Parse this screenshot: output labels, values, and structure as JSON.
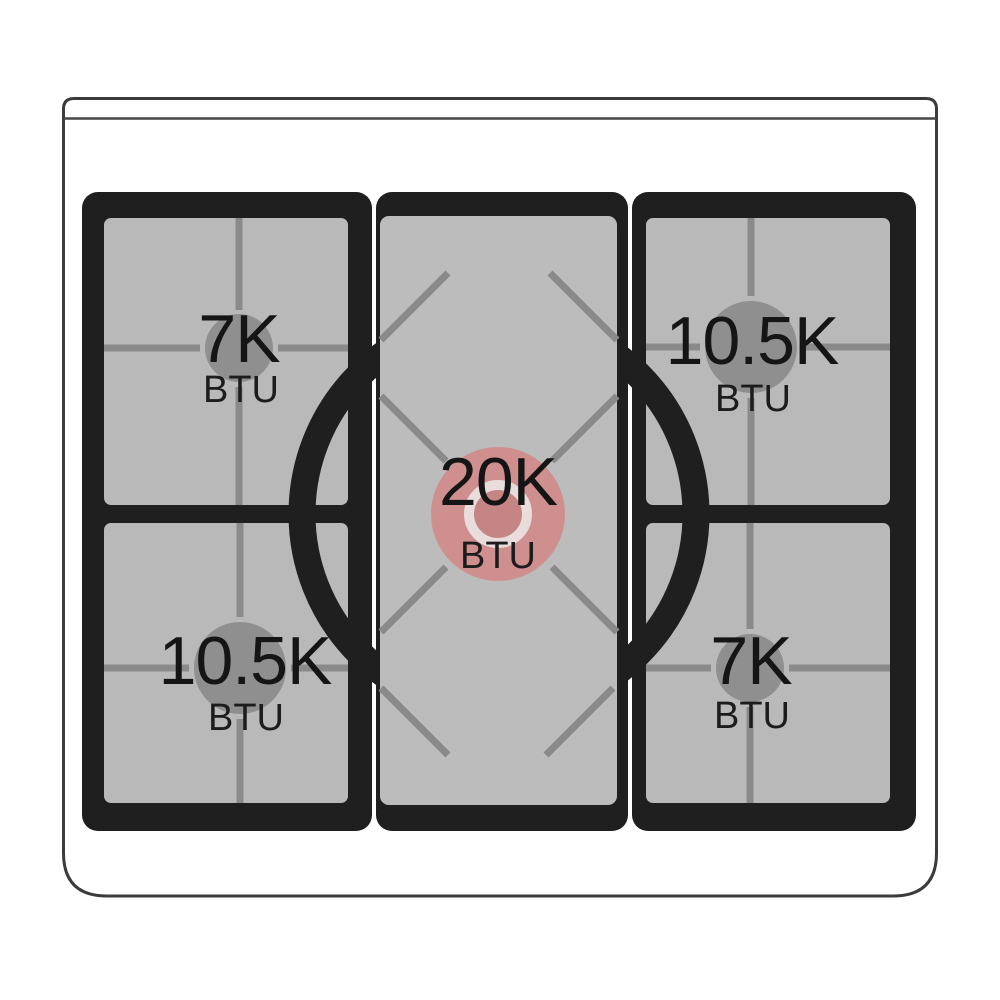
{
  "diagram": {
    "burners": {
      "top_left": {
        "power": "7K",
        "unit": "BTU"
      },
      "top_right": {
        "power": "10.5K",
        "unit": "BTU"
      },
      "center": {
        "power": "20K",
        "unit": "BTU"
      },
      "bottom_left": {
        "power": "10.5K",
        "unit": "BTU"
      },
      "bottom_right": {
        "power": "7K",
        "unit": "BTU"
      }
    },
    "colors": {
      "center_burner_highlight": "#cf8f8f",
      "center_burner_inner": "#c68585",
      "center_burner_ring": "#e8dcdc",
      "side_burner": "#8f8f8f",
      "grate_frame": "#1f1f1f",
      "grate_surface": "#b9b9b9",
      "center_surface": "#bcbcbc",
      "grate_line": "#8a8a8a"
    }
  }
}
